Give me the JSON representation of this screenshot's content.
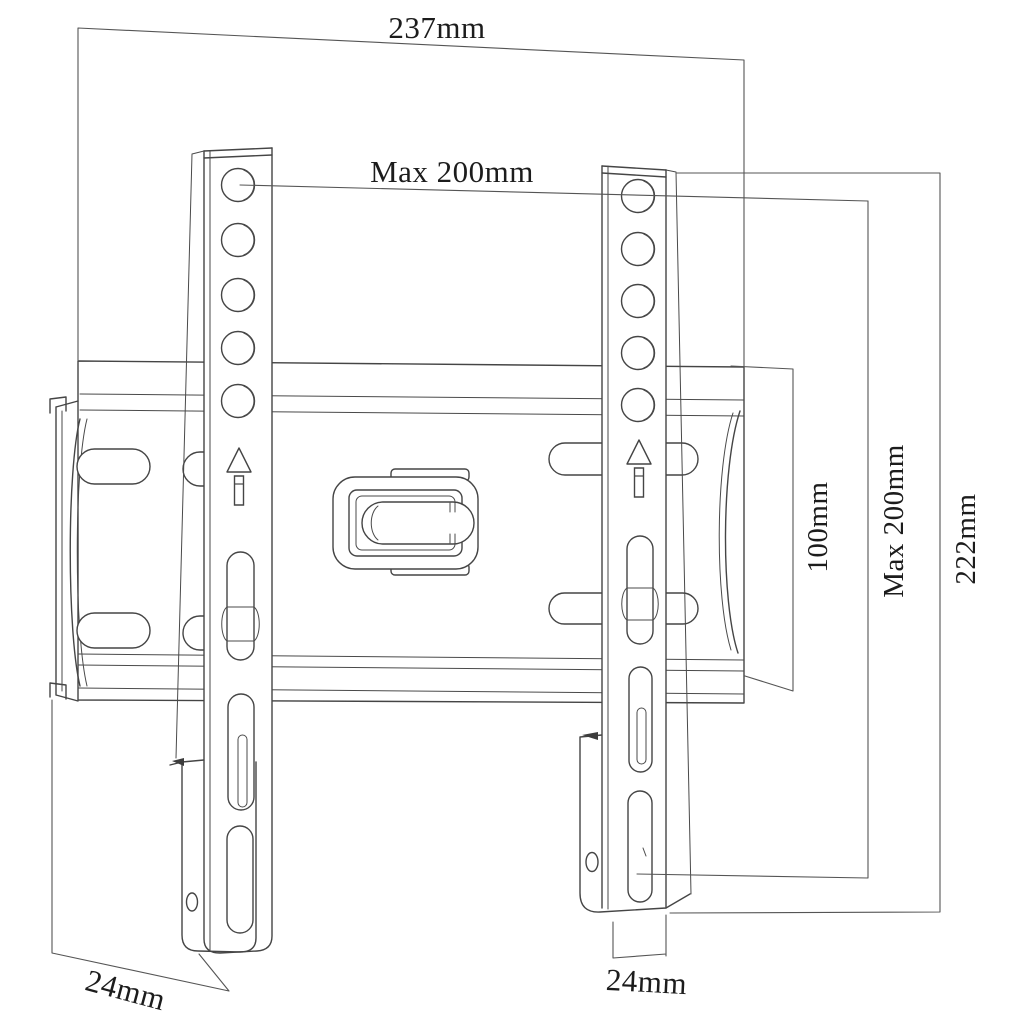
{
  "diagram": {
    "type": "technical-dimension-drawing",
    "subject": "TV wall mount bracket",
    "colors": {
      "background": "#ffffff",
      "line": "#454545",
      "text": "#1c1c1c"
    },
    "icons": [
      "up-arrow-icon",
      "vesa-hole-icon"
    ],
    "dimensions": [
      {
        "id": "top-width",
        "label": "237mm",
        "orientation": "horizontal"
      },
      {
        "id": "max-hole-width",
        "label": "Max 200mm",
        "orientation": "horizontal"
      },
      {
        "id": "plate-height",
        "label": "100mm",
        "orientation": "vertical"
      },
      {
        "id": "max-hole-height",
        "label": "Max 200mm",
        "orientation": "vertical"
      },
      {
        "id": "rail-height",
        "label": "222mm",
        "orientation": "vertical"
      },
      {
        "id": "depth-left",
        "label": "24mm",
        "orientation": "diagonal"
      },
      {
        "id": "depth-bottom",
        "label": "24mm",
        "orientation": "horizontal"
      }
    ]
  }
}
